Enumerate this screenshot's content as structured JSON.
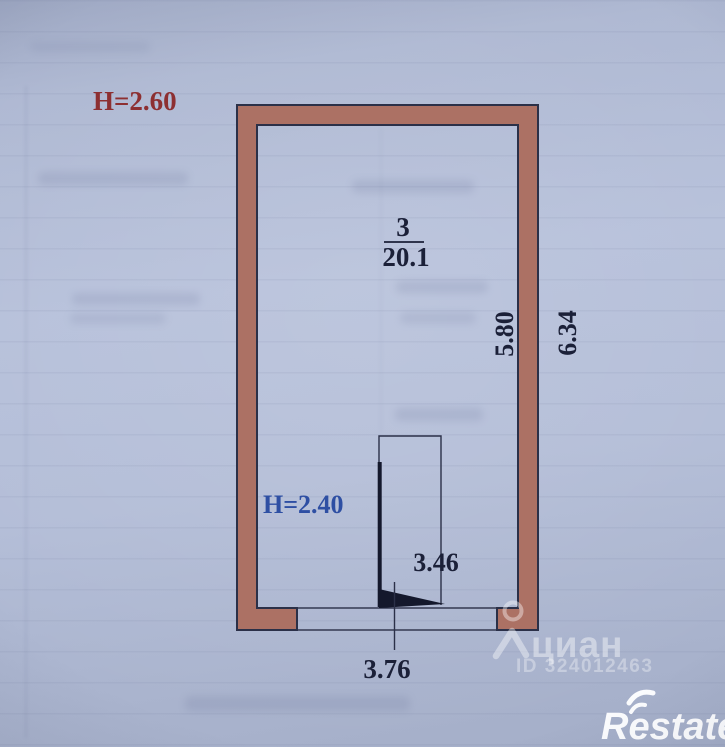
{
  "plan": {
    "height_main": "Н=2.60",
    "height_secondary": "Н=2.40",
    "room_number": "3",
    "room_area": "20.1",
    "dim_depth_inner": "5.80",
    "dim_depth_outer": "6.34",
    "dim_door": "3.46",
    "dim_width": "3.76"
  },
  "watermark": {
    "brand": "циан",
    "listing_id": "ID 324012463"
  },
  "footer_logo": {
    "text": "Restate"
  },
  "colors": {
    "paper": "#b0bad4",
    "wall_fill": "#ac7164",
    "line": "#2b3048",
    "label": "#1b2038",
    "height_main": "#8d2f31",
    "height_secondary": "#2e4fa3",
    "watermark": "#ffffff"
  }
}
